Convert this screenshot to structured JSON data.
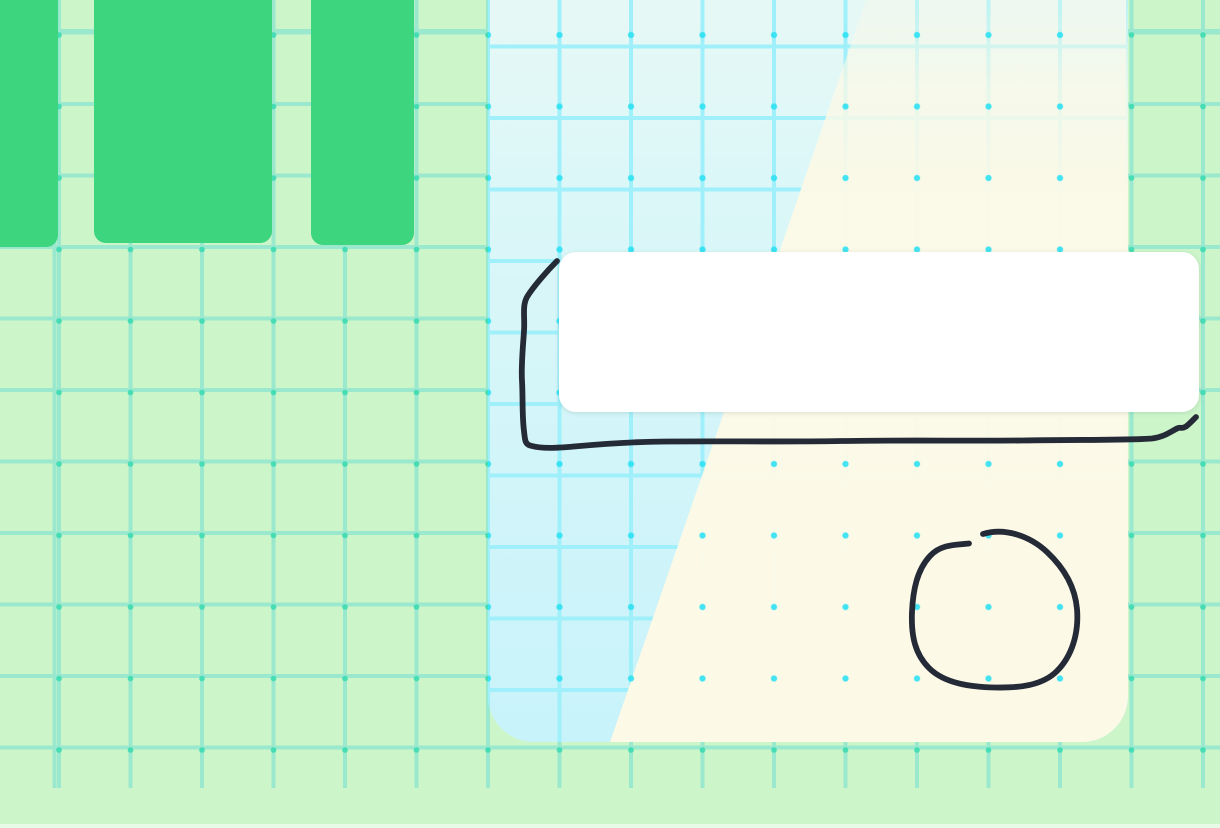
{
  "app": {
    "description": "whiteboard drawing canvas with grid, shape objects and freehand ink strokes"
  },
  "colors": {
    "background": "#cdf5ca",
    "bg_grid_line": "#9ae9cf",
    "bg_grid_dot": "#46dcb4",
    "pillar_green": "#3dd57e",
    "panel_cyan_top": "#eaf9f4",
    "panel_cyan_mid": "#dcf7f8",
    "panel_cyan_bottom": "#c8f3fa",
    "panel_grid_line": "#9ff0fa",
    "panel_grid_dot": "#2ee1f3",
    "panel_cream": "#fcf9e7",
    "card_white": "#ffffff",
    "ink": "#252a37"
  },
  "grid": {
    "spacing_px": 71.5,
    "background_grid_extent_bottom_px": 788
  },
  "objects": {
    "green_rectangles_count": 3,
    "panel": {
      "split": "diagonal cyan-left / cream-right",
      "corner_radius_bottom_px": 46
    },
    "white_card": {
      "x": 559,
      "y": 252,
      "width": 640,
      "height": 160
    }
  },
  "ink": {
    "stroke_count": 2,
    "frame_path": "M 557 261 C 547 271, 533 287, 527 297 C 522 306, 525 317, 524 331 C 523 347, 521 365, 522 381 C 523 398, 522 416, 524 431 C 525 440, 525 444, 530 445.5 C 542 449, 557 448, 574 446.5 C 602 444, 634 441.5, 668 441.5 C 724 441, 782 442, 842 441 C 902 440, 962 441, 1022 440.5 C 1082 439.5, 1122 440.5, 1152 438.5 C 1164 437, 1170 432, 1177 428.5 C 1181 426.5, 1181 429.5, 1186 426.5 C 1190 423.5, 1193 420, 1196 417",
    "circle_path": "M 983 534 C 1006 527, 1031 537, 1047 552 C 1063 567, 1075 586, 1077 609 C 1079 633, 1072 656, 1057 671 C 1042 686, 1018 688, 995 687.5 C 972 687, 945 684, 929 668 C 915 654, 911 636, 912 612 C 913 590, 917 570, 930 556 C 941 544, 956 545, 969 543.5"
  }
}
